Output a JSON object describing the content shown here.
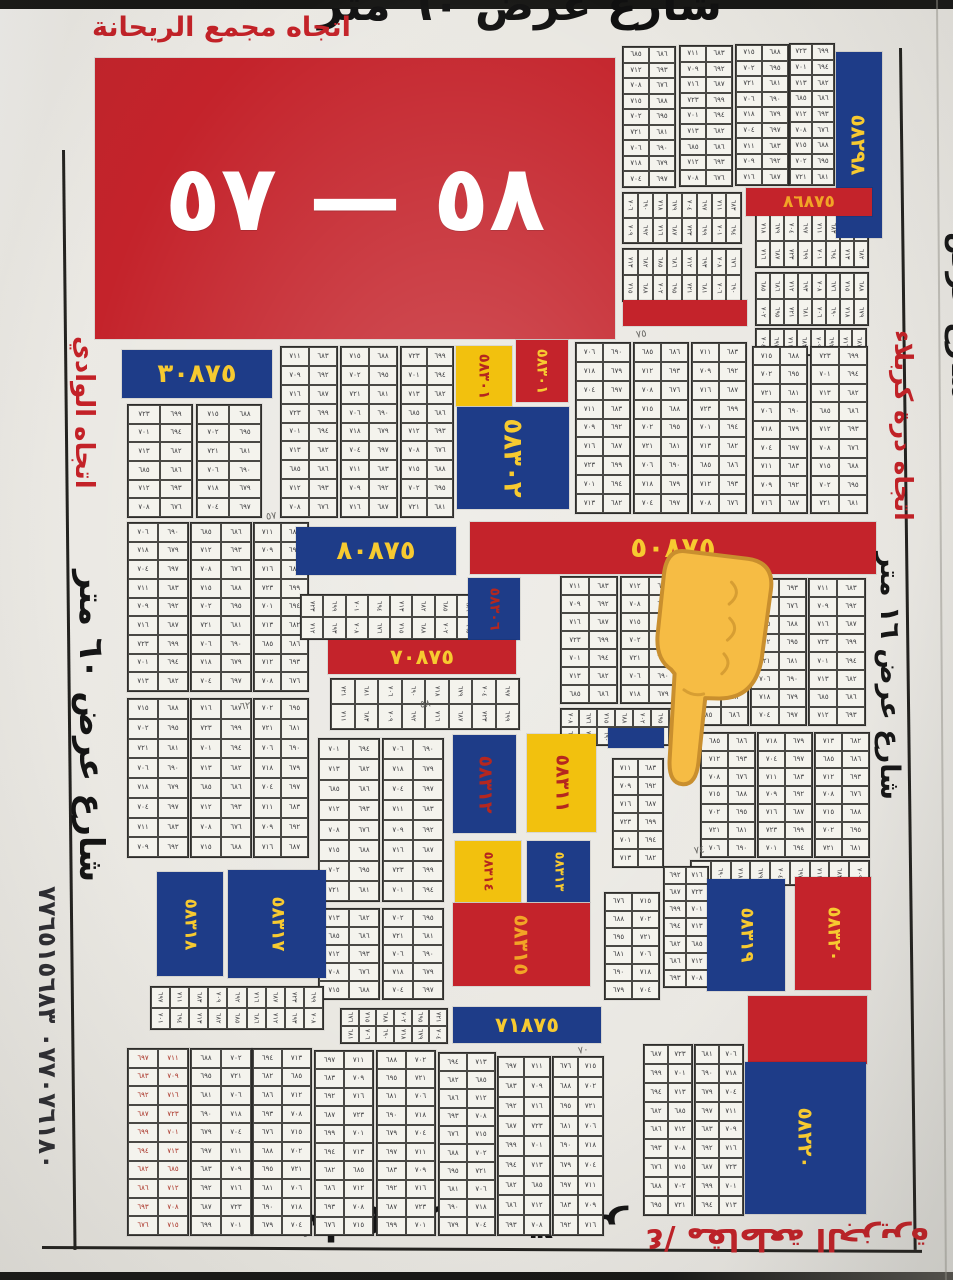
{
  "colors": {
    "red": "#c4232b",
    "blue": "#1e3c88",
    "yellow": "#f2c10e",
    "fg_yellow": "#f7ca30",
    "fg_red": "#b5271f",
    "fg_white": "#ffffff",
    "fg_orange": "#f2a426"
  },
  "header": {
    "street": "شارع عرض ٦٠ متر",
    "direction": "اتجاه مجمع الريحانة"
  },
  "banner": {
    "label": "٥٨ — ٥٧"
  },
  "edges": {
    "right_direction": "اتجاه درة كربلاء",
    "right_street": "شارع عرض ١٦ متر",
    "right_partial": "شارع عرض",
    "left_direction": "اتجاه الوادي",
    "left_street": "شارع عرض ٦٠ متر",
    "phone": "٠٧٧٠٧٦١٨٠ ٧٧٦٥١٥٦٨٣",
    "bottom_street": "شارع عرض ٣٠ متر",
    "bottom_direction": "٤/ مقاطعة الجزيرة"
  },
  "blocks": [
    {
      "label": "٥٨٢٩٨",
      "x": 836,
      "y": 52,
      "w": 46,
      "h": 186,
      "bg": "blue",
      "fg": "fg_yellow",
      "v": 1,
      "fs": 20
    },
    {
      "label": "٨٦٨٧٥",
      "x": 746,
      "y": 188,
      "w": 126,
      "h": 28,
      "bg": "red",
      "fg": "fg_orange",
      "fs": 17
    },
    {
      "label": "",
      "x": 623,
      "y": 300,
      "w": 124,
      "h": 26,
      "bg": "red"
    },
    {
      "label": "٣٠٨٧٥",
      "x": 122,
      "y": 350,
      "w": 150,
      "h": 48,
      "bg": "blue",
      "fg": "fg_yellow",
      "fs": 26
    },
    {
      "label": "٥٨٣٠١",
      "x": 456,
      "y": 346,
      "w": 56,
      "h": 60,
      "bg": "yellow",
      "fg": "fg_red",
      "v": 1,
      "fs": 15
    },
    {
      "label": "٥٨٣٠١",
      "x": 516,
      "y": 340,
      "w": 52,
      "h": 62,
      "bg": "red",
      "fg": "fg_yellow",
      "v": 1,
      "fs": 15
    },
    {
      "label": "٥٨٣٠٢",
      "x": 457,
      "y": 407,
      "w": 112,
      "h": 102,
      "bg": "blue",
      "fg": "fg_yellow",
      "v": 1,
      "fs": 26
    },
    {
      "label": "٨٠٨٧٥",
      "x": 296,
      "y": 527,
      "w": 160,
      "h": 48,
      "bg": "blue",
      "fg": "fg_yellow",
      "fs": 26
    },
    {
      "label": "٥٠٨٧٥",
      "x": 470,
      "y": 522,
      "w": 406,
      "h": 52,
      "bg": "red",
      "fg": "fg_yellow",
      "fs": 28
    },
    {
      "label": "٥٨٣٠٦",
      "x": 468,
      "y": 578,
      "w": 52,
      "h": 62,
      "bg": "blue",
      "fg": "fg_red",
      "v": 1,
      "fs": 14
    },
    {
      "label": "٧٠٨٧٥",
      "x": 328,
      "y": 640,
      "w": 188,
      "h": 34,
      "bg": "red",
      "fg": "fg_yellow",
      "fs": 21
    },
    {
      "label": "",
      "x": 608,
      "y": 728,
      "w": 56,
      "h": 20,
      "bg": "blue"
    },
    {
      "label": "٥٨٣١٢",
      "x": 453,
      "y": 735,
      "w": 63,
      "h": 98,
      "bg": "blue",
      "fg": "fg_red",
      "v": 1,
      "fs": 19
    },
    {
      "label": "٥٨٣١١",
      "x": 527,
      "y": 734,
      "w": 69,
      "h": 98,
      "bg": "yellow",
      "fg": "fg_red",
      "v": 1,
      "fs": 19
    },
    {
      "label": "٥٨٣١٤",
      "x": 455,
      "y": 841,
      "w": 66,
      "h": 61,
      "bg": "yellow",
      "fg": "fg_red",
      "v": 1,
      "fs": 13
    },
    {
      "label": "٥٨٣١٣",
      "x": 527,
      "y": 841,
      "w": 63,
      "h": 61,
      "bg": "blue",
      "fg": "fg_yellow",
      "v": 1,
      "fs": 13
    },
    {
      "label": "٥٨٣١٥",
      "x": 453,
      "y": 903,
      "w": 137,
      "h": 83,
      "bg": "red",
      "fg": "fg_orange",
      "v": 1,
      "fs": 20
    },
    {
      "label": "٧١٨٧٥",
      "x": 453,
      "y": 1007,
      "w": 148,
      "h": 36,
      "bg": "blue",
      "fg": "fg_yellow",
      "fs": 21
    },
    {
      "label": "٥٨٣١٨",
      "x": 157,
      "y": 872,
      "w": 66,
      "h": 104,
      "bg": "blue",
      "fg": "fg_yellow",
      "v": 1,
      "fs": 17
    },
    {
      "label": "٥٨٣١٧",
      "x": 228,
      "y": 870,
      "w": 98,
      "h": 108,
      "bg": "blue",
      "fg": "fg_yellow",
      "v": 1,
      "fs": 18
    },
    {
      "label": "٥٨٣١٩",
      "x": 707,
      "y": 879,
      "w": 78,
      "h": 112,
      "bg": "blue",
      "fg": "fg_yellow",
      "v": 1,
      "fs": 18
    },
    {
      "label": "٥٨٣٢٠",
      "x": 795,
      "y": 877,
      "w": 76,
      "h": 113,
      "bg": "red",
      "fg": "fg_yellow",
      "v": 1,
      "fs": 18
    },
    {
      "label": "",
      "x": 748,
      "y": 996,
      "w": 119,
      "h": 68,
      "bg": "red"
    },
    {
      "label": "٥٨٢٢٠",
      "x": 745,
      "y": 1062,
      "w": 121,
      "h": 152,
      "bg": "blue",
      "fg": "fg_yellow",
      "v": 1,
      "fs": 20
    }
  ],
  "grids": [
    [
      622,
      46,
      52,
      140,
      2,
      9
    ],
    [
      679,
      45,
      52,
      140,
      2,
      9
    ],
    [
      735,
      44,
      52,
      140,
      2,
      9
    ],
    [
      789,
      43,
      44,
      141,
      2,
      9
    ],
    [
      622,
      192,
      118,
      50,
      8,
      2
    ],
    [
      622,
      248,
      118,
      52,
      8,
      2
    ],
    [
      755,
      214,
      112,
      52,
      8,
      2
    ],
    [
      755,
      272,
      112,
      52,
      8,
      2
    ],
    [
      755,
      328,
      110,
      26,
      8,
      1
    ],
    [
      127,
      404,
      64,
      112,
      2,
      6
    ],
    [
      196,
      404,
      64,
      112,
      2,
      6
    ],
    [
      280,
      346,
      56,
      170,
      2,
      9
    ],
    [
      340,
      346,
      56,
      170,
      2,
      9
    ],
    [
      400,
      346,
      52,
      170,
      2,
      9
    ],
    [
      575,
      342,
      54,
      170,
      2,
      9
    ],
    [
      633,
      342,
      54,
      170,
      2,
      9
    ],
    [
      691,
      342,
      54,
      170,
      2,
      9
    ],
    [
      752,
      346,
      54,
      166,
      2,
      9
    ],
    [
      810,
      346,
      56,
      166,
      2,
      9
    ],
    [
      127,
      522,
      60,
      168,
      2,
      9
    ],
    [
      190,
      522,
      60,
      168,
      2,
      9
    ],
    [
      253,
      522,
      54,
      168,
      2,
      9
    ],
    [
      127,
      698,
      60,
      158,
      2,
      8
    ],
    [
      190,
      698,
      60,
      158,
      2,
      8
    ],
    [
      253,
      698,
      54,
      158,
      2,
      8
    ],
    [
      300,
      594,
      178,
      44,
      8,
      2
    ],
    [
      330,
      678,
      188,
      50,
      8,
      2
    ],
    [
      318,
      738,
      60,
      162,
      2,
      8
    ],
    [
      382,
      738,
      60,
      162,
      2,
      8
    ],
    [
      318,
      908,
      60,
      90,
      2,
      5
    ],
    [
      382,
      908,
      60,
      90,
      2,
      5
    ],
    [
      560,
      576,
      56,
      126,
      2,
      7
    ],
    [
      620,
      576,
      56,
      126,
      2,
      7
    ],
    [
      692,
      578,
      55,
      146,
      2,
      8
    ],
    [
      750,
      578,
      55,
      146,
      2,
      8
    ],
    [
      808,
      578,
      56,
      146,
      2,
      8
    ],
    [
      560,
      708,
      126,
      36,
      7,
      2
    ],
    [
      612,
      758,
      50,
      108,
      2,
      6
    ],
    [
      700,
      732,
      54,
      124,
      2,
      7
    ],
    [
      757,
      732,
      54,
      124,
      2,
      7
    ],
    [
      814,
      732,
      54,
      124,
      2,
      7
    ],
    [
      690,
      860,
      178,
      24,
      9,
      1
    ],
    [
      663,
      866,
      44,
      120,
      2,
      7
    ],
    [
      604,
      892,
      54,
      106,
      2,
      6
    ],
    [
      150,
      986,
      172,
      42,
      9,
      2
    ],
    [
      340,
      1008,
      106,
      34,
      6,
      2
    ],
    [
      127,
      1048,
      60,
      186,
      2,
      10,
      "red"
    ],
    [
      190,
      1048,
      60,
      186,
      2,
      10
    ],
    [
      252,
      1048,
      58,
      186,
      2,
      10
    ],
    [
      314,
      1050,
      58,
      184,
      2,
      10
    ],
    [
      376,
      1050,
      58,
      184,
      2,
      10
    ],
    [
      438,
      1052,
      56,
      182,
      2,
      10
    ],
    [
      497,
      1056,
      52,
      178,
      2,
      9
    ],
    [
      552,
      1056,
      50,
      178,
      2,
      9
    ],
    [
      643,
      1044,
      48,
      170,
      2,
      9
    ],
    [
      694,
      1044,
      48,
      170,
      2,
      9
    ]
  ],
  "grid_digits": [
    "٦٨٥",
    "٦٨٦",
    "٧١٢",
    "٦٩٣",
    "٧٠٨",
    "٦٧٦",
    "٧١٥",
    "٦٨٨",
    "٧٠٢",
    "٦٩٥",
    "٧٢١",
    "٦٨١",
    "٧٠٦",
    "٦٩٠",
    "٧١٨",
    "٦٧٩",
    "٧٠٤",
    "٦٩٧",
    "٧١١",
    "٦٨٣",
    "٧٠٩",
    "٦٩٢",
    "٧١٦",
    "٦٨٧",
    "٧٢٣",
    "٦٩٩",
    "٧٠١",
    "٦٩٤",
    "٧١٣",
    "٦٨٢"
  ],
  "marks": [
    {
      "x": 266,
      "y": 512,
      "t": "٥٧"
    },
    {
      "x": 636,
      "y": 330,
      "t": "٧٥"
    },
    {
      "x": 420,
      "y": 700,
      "t": "٥٨"
    },
    {
      "x": 694,
      "y": 846,
      "t": "٧٤"
    },
    {
      "x": 240,
      "y": 702,
      "t": "٦٢"
    },
    {
      "x": 578,
      "y": 1046,
      "t": "٧٠"
    }
  ],
  "hand": {
    "x": 626,
    "y": 545,
    "w": 140,
    "h": 252
  }
}
